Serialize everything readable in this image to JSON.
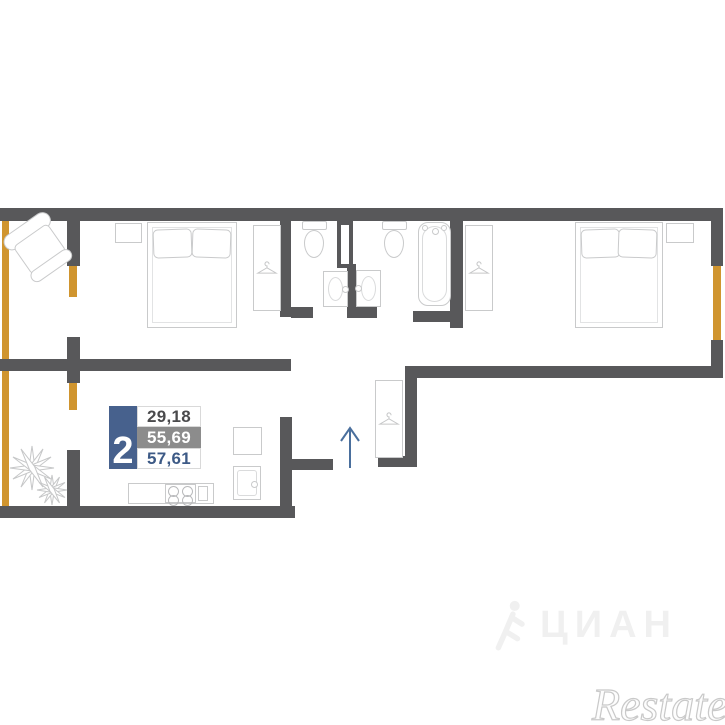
{
  "plan": {
    "type": "apartment-floor-plan",
    "rooms_label": "2",
    "areas": [
      {
        "value": "29,18",
        "style": "light"
      },
      {
        "value": "55,69",
        "style": "gray"
      },
      {
        "value": "57,61",
        "style": "accent"
      }
    ]
  },
  "watermarks": {
    "cian": "ЦИАН",
    "restate": "Restate"
  },
  "icons": {
    "hanger": "hanger-icon",
    "entrance_arrow": "arrow-up-icon",
    "plant": "plant-icon",
    "cian_person": "runner-icon"
  },
  "colors": {
    "wall": "#58585a",
    "window": "#d0952f",
    "badge-blue": "#47618d",
    "row-gray": "#8c8c8c",
    "text-dark": "#4a4a4c",
    "text-accent": "#3d5a86",
    "furniture-line": "#c9cacb",
    "arrow-blue": "#4a6f9d",
    "wm-cian": "#f0f0f0",
    "wm-restate": "#c9c9c9"
  }
}
